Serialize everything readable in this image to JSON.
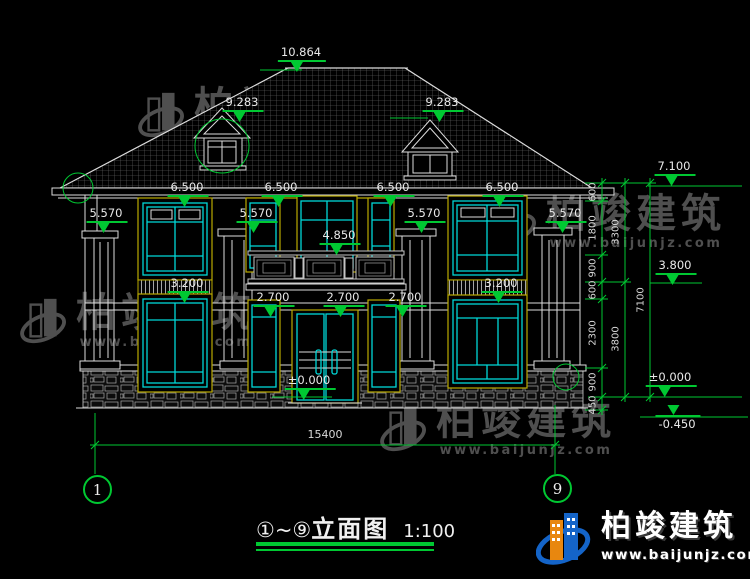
{
  "colors": {
    "dim_green": "#00c832",
    "window_cyan": "#00d8d8",
    "frame_yellow": "#b9a900",
    "line_white": "#dcdcdc"
  },
  "watermark": {
    "brand": "柏竣建筑",
    "url": "www.baijunjz.com"
  },
  "brand_logo": {
    "brand": "柏竣建筑",
    "url": "www.baijunjz.com"
  },
  "title_block": {
    "range": "①~⑨",
    "name": "立面图",
    "scale": "1:100"
  },
  "axis": {
    "left": "1",
    "right": "9"
  },
  "elevation_marks": {
    "ridge": "10.864",
    "dormer_left": "9.283",
    "dormer_right": "9.283",
    "eave_1": "6.500",
    "eave_2": "6.500",
    "eave_3": "6.500",
    "eave_4": "6.500",
    "capital_1": "5.570",
    "capital_2": "5.570",
    "capital_3": "5.570",
    "capital_4": "5.570",
    "balcony": "4.850",
    "sill_left": "3.200",
    "sill_right": "3.200",
    "floor2_1": "2.700",
    "floor2_2": "2.700",
    "floor2_3": "2.700",
    "ground_center": "±0.000",
    "eave_right": "7.100",
    "level_right": "3.800",
    "ground_right": "±0.000",
    "basement": "-0.450"
  },
  "dim_chain": {
    "inner": [
      "600",
      "1800",
      "900",
      "600",
      "2300",
      "900",
      "450"
    ],
    "mid": [
      "3300",
      "3800"
    ],
    "outer": [
      "7100"
    ],
    "total": "15400"
  }
}
